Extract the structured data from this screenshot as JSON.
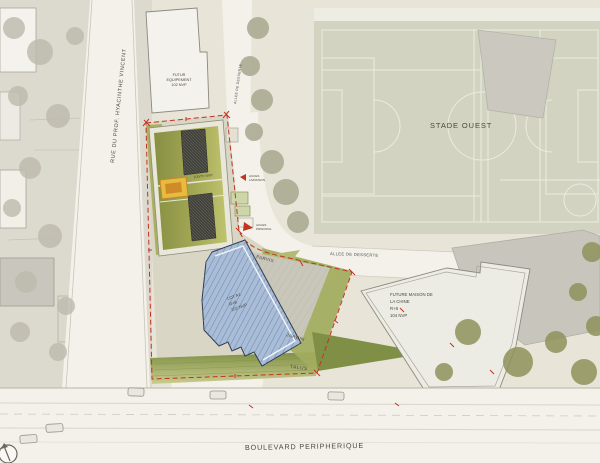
{
  "plan_title": "architectural site plan",
  "streets": {
    "rue_prof": "RUE DU PROF. HYACINTHE VINCENT",
    "allee_top": "ALLEE DE DESSERTE",
    "allee_mid": "ALLEE DE DESSERTE",
    "boulevard": "BOULEVARD PERIPHERIQUE"
  },
  "areas": {
    "stade": "STADE OUEST",
    "parvis": "PARVIS",
    "jardin": "JARDIN",
    "talus": "TALUS"
  },
  "buildings": {
    "futur_equipement": {
      "lines": [
        "FUTUR",
        "EQUIPEMENT",
        "102 NVP"
      ]
    },
    "lot_b": {
      "lines": [
        "R+2",
        "100/70 NVP"
      ]
    },
    "lot_a1": {
      "lines": [
        "LOT A1",
        "R+8",
        "102 NVP"
      ]
    },
    "maison_chine": {
      "lines": [
        "FUTURE MAISON DE",
        "LA CHINE",
        "R+8",
        "104 NVP"
      ]
    }
  },
  "annotations": {
    "acces_livraison": {
      "lines": [
        "ACCES",
        "LIVRAISON"
      ]
    },
    "acces_principal": {
      "lines": [
        "ACCES",
        "PRINCIPAL"
      ]
    }
  },
  "icons": {
    "north_arrow": "north-arrow-compass"
  },
  "colors": {
    "paper": "#e8e4d8",
    "context_gray": "#dcd9cf",
    "road": "#f3f1ea",
    "field": "#d2d4c1",
    "field_lines": "#f6f5ee",
    "roof_green": "#9aa052",
    "building_blue": "#a9bdd8",
    "parcel_white": "#edece4",
    "gray_building": "#c8c6bc",
    "boundary_red": "#c23321",
    "label_dark": "#4a483e"
  }
}
